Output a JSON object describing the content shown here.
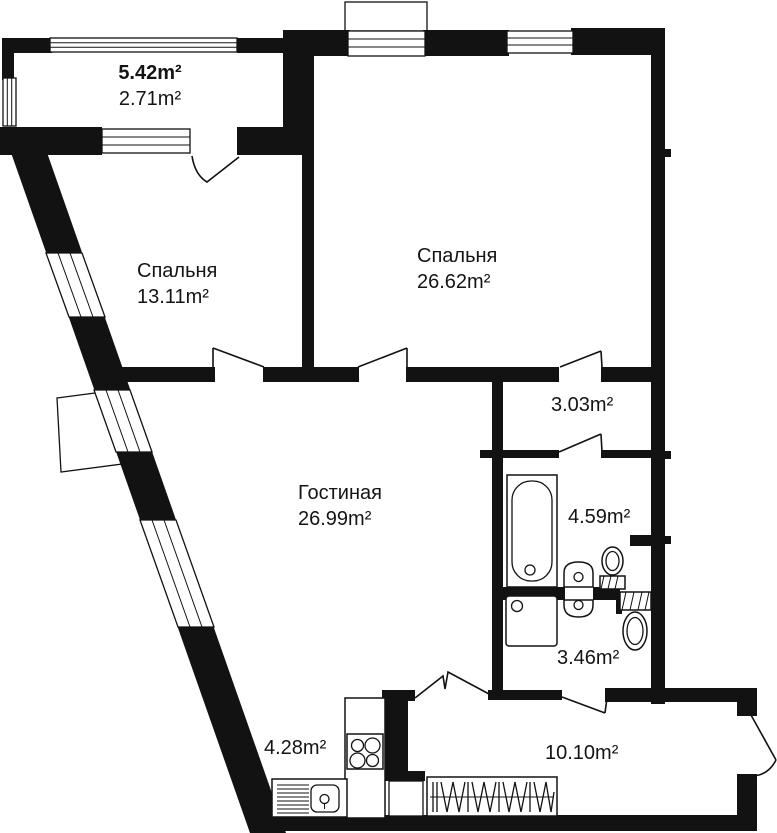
{
  "colors": {
    "wall": "#121212",
    "floor": "#ffffff",
    "text": "#141414"
  },
  "rooms": {
    "balcony": {
      "area_total": "5.42m²",
      "area_reduced": "2.71m²"
    },
    "bedroom1": {
      "name": "Спальня",
      "area": "13.11m²"
    },
    "bedroom2": {
      "name": "Спальня",
      "area": "26.62m²"
    },
    "corridor": {
      "area": "3.03m²"
    },
    "bathroom": {
      "area": "4.59m²"
    },
    "wc": {
      "area": "3.46m²"
    },
    "living": {
      "name": "Гостиная",
      "area": "26.99m²"
    },
    "kitchen": {
      "area": "4.28m²"
    },
    "hallway": {
      "area": "10.10m²"
    }
  }
}
